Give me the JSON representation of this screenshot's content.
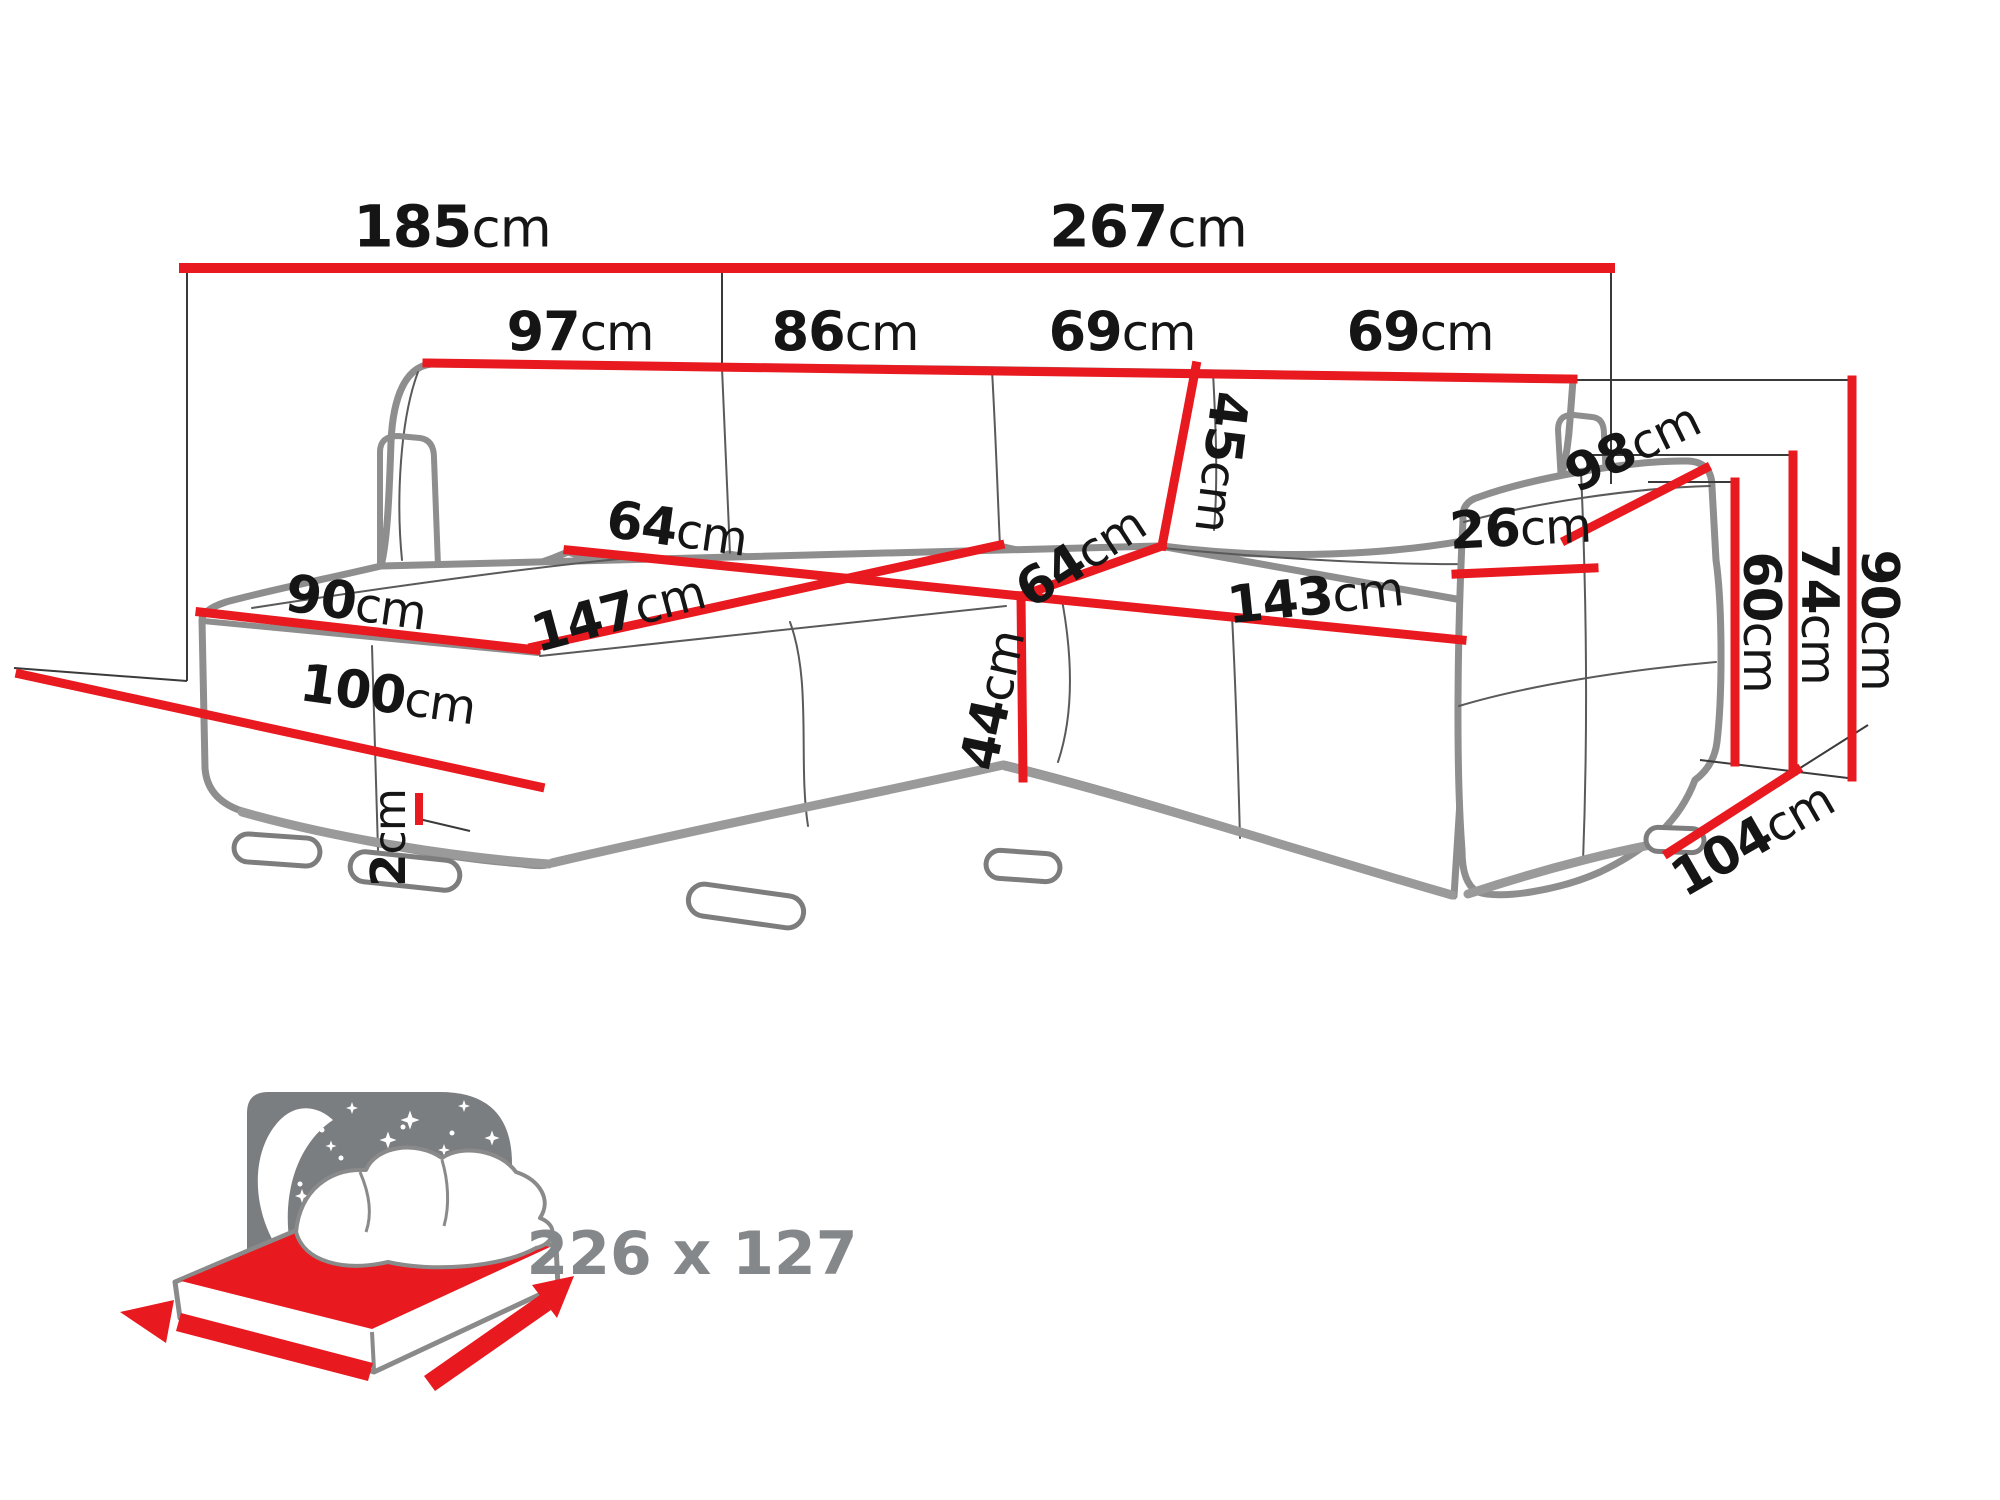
{
  "diagram_type": "corner-sofa-dimension-drawing",
  "colors": {
    "dimension_red": "#e8191f",
    "label_black": "#151515",
    "sofa_outline_gray": "#8e8e8e",
    "icon_panel_gray": "#7b7e81",
    "icon_text_gray": "#85888b"
  },
  "measurements": [
    {
      "id": "width-left-section",
      "value": "185",
      "unit": "cm"
    },
    {
      "id": "width-main-section",
      "value": "267",
      "unit": "cm"
    },
    {
      "id": "back-cushion-1",
      "value": "97",
      "unit": "cm"
    },
    {
      "id": "back-cushion-2",
      "value": "86",
      "unit": "cm"
    },
    {
      "id": "back-cushion-3",
      "value": "69",
      "unit": "cm"
    },
    {
      "id": "back-cushion-4",
      "value": "69",
      "unit": "cm"
    },
    {
      "id": "back-cushion-height",
      "value": "45",
      "unit": "cm"
    },
    {
      "id": "seat-depth",
      "value": "64",
      "unit": "cm"
    },
    {
      "id": "corner-seat-depth",
      "value": "64",
      "unit": "cm"
    },
    {
      "id": "chaise-length",
      "value": "147",
      "unit": "cm"
    },
    {
      "id": "chaise-width",
      "value": "90",
      "unit": "cm"
    },
    {
      "id": "chaise-front-length",
      "value": "100",
      "unit": "cm"
    },
    {
      "id": "leg-height",
      "value": "2",
      "unit": "cm"
    },
    {
      "id": "seat-height",
      "value": "44",
      "unit": "cm"
    },
    {
      "id": "right-seat-width",
      "value": "143",
      "unit": "cm"
    },
    {
      "id": "armrest-width",
      "value": "26",
      "unit": "cm"
    },
    {
      "id": "armrest-length",
      "value": "98",
      "unit": "cm"
    },
    {
      "id": "armrest-height",
      "value": "60",
      "unit": "cm"
    },
    {
      "id": "side-back-height",
      "value": "74",
      "unit": "cm"
    },
    {
      "id": "total-height",
      "value": "90",
      "unit": "cm"
    },
    {
      "id": "side-depth",
      "value": "104",
      "unit": "cm"
    }
  ],
  "sleeping_area": {
    "label": "226 x 127"
  }
}
